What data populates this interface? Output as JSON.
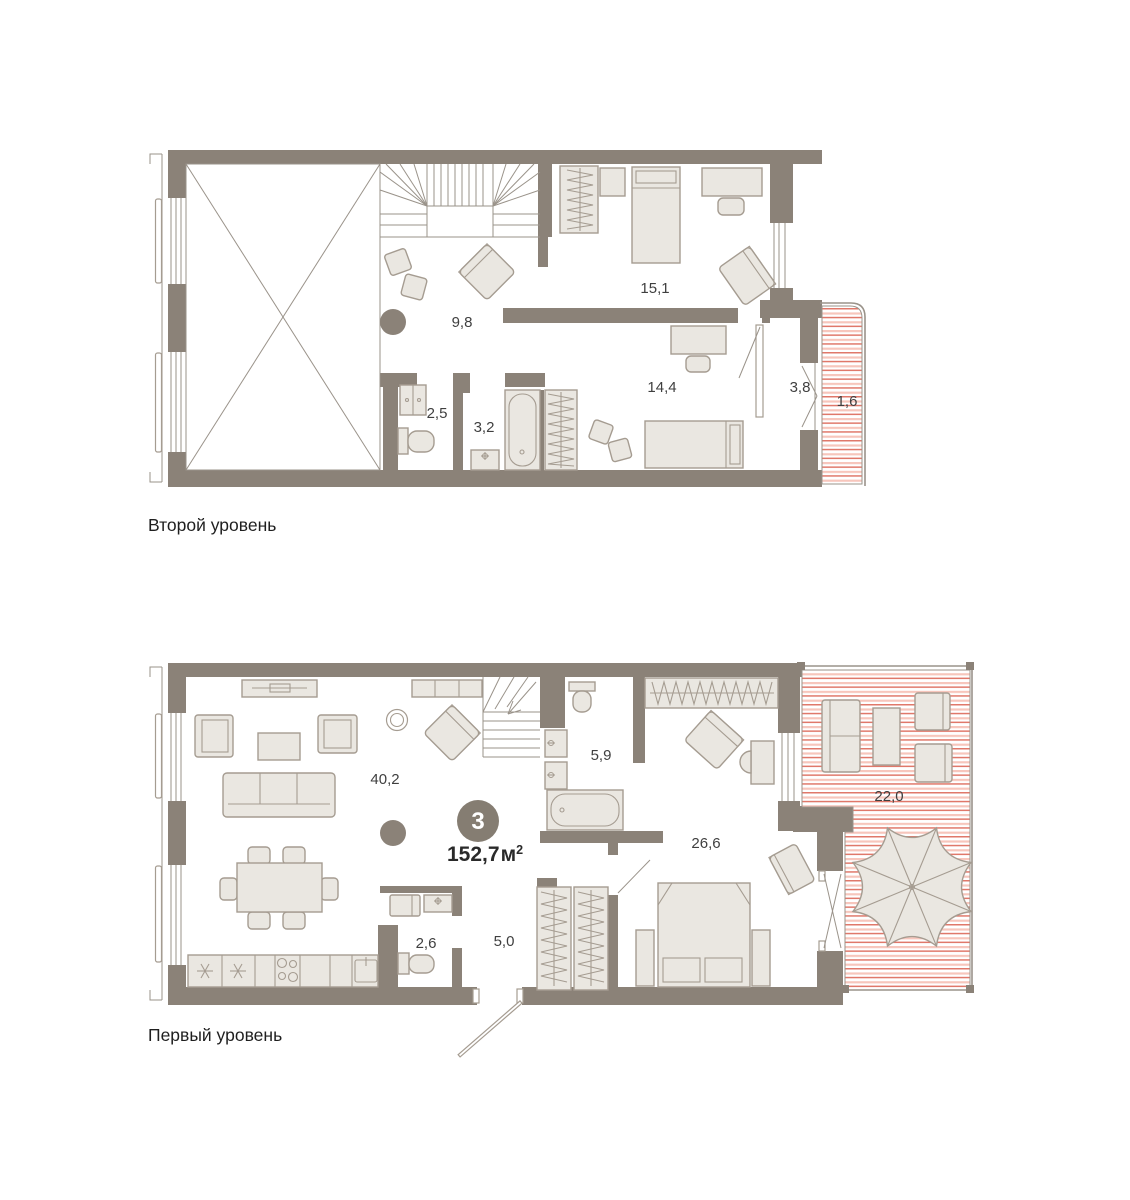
{
  "apartment": {
    "rooms_count": "3",
    "area_value": "152,7",
    "area_unit": "м",
    "area_sup": "2"
  },
  "levels": [
    {
      "id": "level-2",
      "title": "Второй уровень",
      "rooms": [
        {
          "name": "lounge",
          "area": "9,8"
        },
        {
          "name": "bedroom-upper",
          "area": "15,1"
        },
        {
          "name": "bedroom-lower",
          "area": "14,4"
        },
        {
          "name": "wardrobe-room",
          "area": "3,8"
        },
        {
          "name": "balcony",
          "area": "1,6"
        },
        {
          "name": "wc",
          "area": "2,5"
        },
        {
          "name": "bathroom",
          "area": "3,2"
        }
      ]
    },
    {
      "id": "level-1",
      "title": "Первый уровень",
      "rooms": [
        {
          "name": "living-kitchen",
          "area": "40,2"
        },
        {
          "name": "bathroom",
          "area": "5,9"
        },
        {
          "name": "master-bedroom",
          "area": "26,6"
        },
        {
          "name": "terrace",
          "area": "22,0"
        },
        {
          "name": "wc-laundry",
          "area": "2,6"
        },
        {
          "name": "hallway",
          "area": "5,0"
        }
      ]
    }
  ],
  "symbols": {
    "fridge": "snowflake",
    "terrace_shade": "umbrella",
    "void_space": "crossed-rectangle",
    "stairs_direction": "arrow"
  },
  "colors": {
    "wall": "#8b8278",
    "furn_fill": "#eae7e1",
    "furn_stroke": "#a59c91",
    "line": "#9a938a",
    "hatch_dark": "#e0786a",
    "hatch_light": "#f7c6bc",
    "text": "#3f3f3f",
    "title": "#1f1f1f",
    "badge_bg": "#857d72",
    "badge_text": "#ffffff",
    "bg": "#ffffff"
  }
}
